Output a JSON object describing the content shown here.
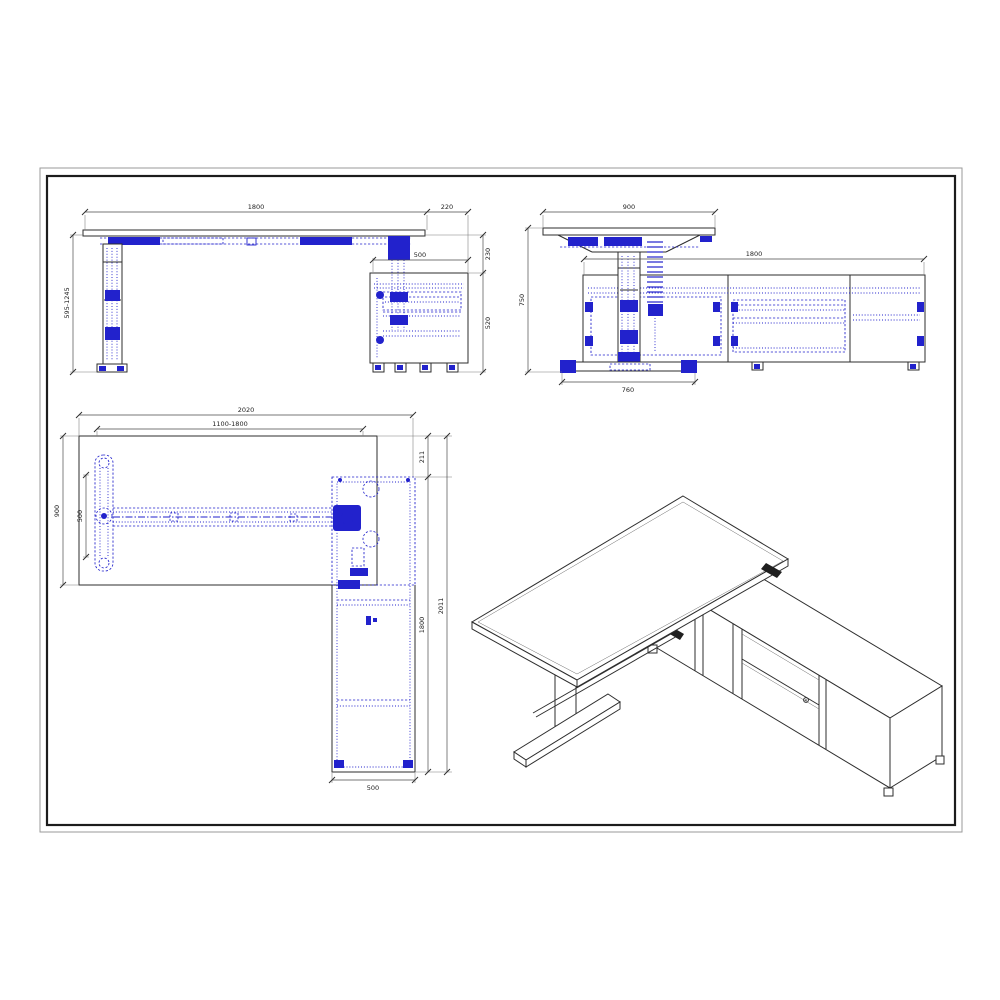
{
  "colors": {
    "outline": "#2e2e2e",
    "blue_detail": "#2222cc",
    "dimension_text": "#222222",
    "background": "#ffffff"
  },
  "views": {
    "front": {
      "dims": {
        "desk_width": "1800",
        "side_overhang": "220",
        "cabinet_depth": "500",
        "height_range": "595-1245",
        "desk_to_cabinet_gap": "230",
        "cabinet_height": "520"
      }
    },
    "side": {
      "dims": {
        "desk_depth": "900",
        "cabinet_length": "1800",
        "fixed_height": "750",
        "foot_length": "760"
      }
    },
    "plan": {
      "dims": {
        "overall_width": "2020",
        "frame_range": "1100-1800",
        "desk_depth": "900",
        "foot_width": "500",
        "rear_offset": "211",
        "cabinet_length": "1800",
        "overall_depth": "2011",
        "cabinet_width": "500"
      }
    }
  }
}
